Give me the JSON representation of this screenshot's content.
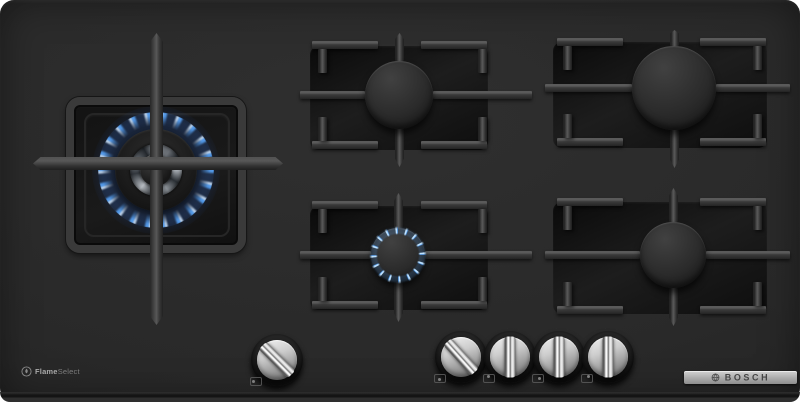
{
  "brand": {
    "name": "BOSCH"
  },
  "badges": {
    "flameselect": {
      "part1": "Flame",
      "part2": "Select"
    }
  },
  "appliance": {
    "type": "5-burner gas hob, black tempered glass",
    "burners": [
      {
        "name": "wok-burner-left",
        "state": "lit-high-flame"
      },
      {
        "name": "burner-top-middle",
        "state": "off"
      },
      {
        "name": "burner-bottom-middle",
        "state": "lit-simmer-flame"
      },
      {
        "name": "burner-top-right",
        "state": "off"
      },
      {
        "name": "burner-bottom-right",
        "state": "off"
      }
    ],
    "knobs": [
      {
        "name": "knob-1",
        "state": "on",
        "angle_deg": -45
      },
      {
        "name": "knob-2",
        "state": "on",
        "angle_deg": -42
      },
      {
        "name": "knob-3",
        "state": "off",
        "angle_deg": 0
      },
      {
        "name": "knob-4",
        "state": "off",
        "angle_deg": 0
      },
      {
        "name": "knob-5",
        "state": "off",
        "angle_deg": 0
      }
    ]
  },
  "colors": {
    "flame_blue": "#5aa8ff",
    "surface_dark": "#292929",
    "badge_silver": "#ababab",
    "badge_text": "#454545"
  }
}
